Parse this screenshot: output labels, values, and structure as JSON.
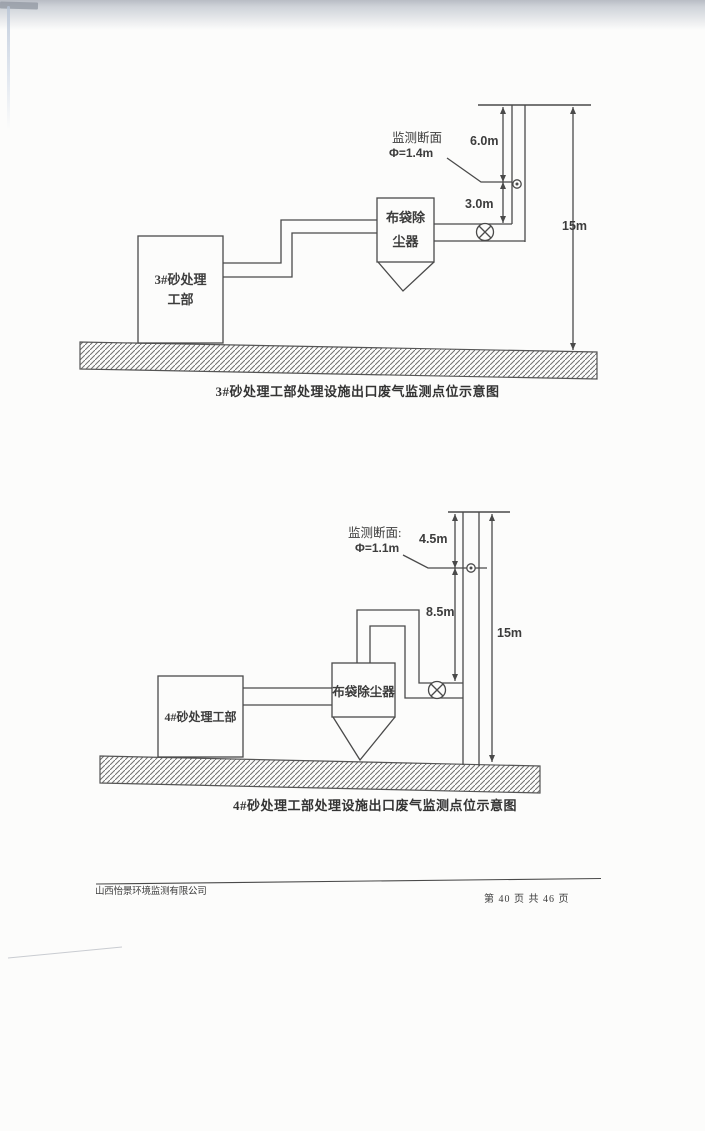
{
  "figure1": {
    "monitor_label": {
      "line1": "监测断面",
      "line2": "Φ=1.4m"
    },
    "dims": {
      "top": "6.0m",
      "mid": "3.0m",
      "total": "15m"
    },
    "source_box": {
      "line1": "3#砂处理",
      "line2": "工部"
    },
    "collector": {
      "line1": "布袋除",
      "line2": "尘器"
    },
    "caption": "3#砂处理工部处理设施出口废气监测点位示意图"
  },
  "figure2": {
    "monitor_label": {
      "line1": "监测断面:",
      "line2": "Φ=1.1m"
    },
    "dims": {
      "top": "4.5m",
      "mid": "8.5m",
      "total": "15m"
    },
    "source_box": {
      "label": "4#砂处理工部"
    },
    "collector": {
      "label": "布袋除尘器"
    },
    "caption": "4#砂处理工部处理设施出口废气监测点位示意图"
  },
  "footer": {
    "company": "山西怡景环境监测有限公司",
    "page_info": "第 40 页 共 46 页"
  },
  "colors": {
    "line": "#4a4a4a",
    "paper": "#fcfcfb"
  }
}
